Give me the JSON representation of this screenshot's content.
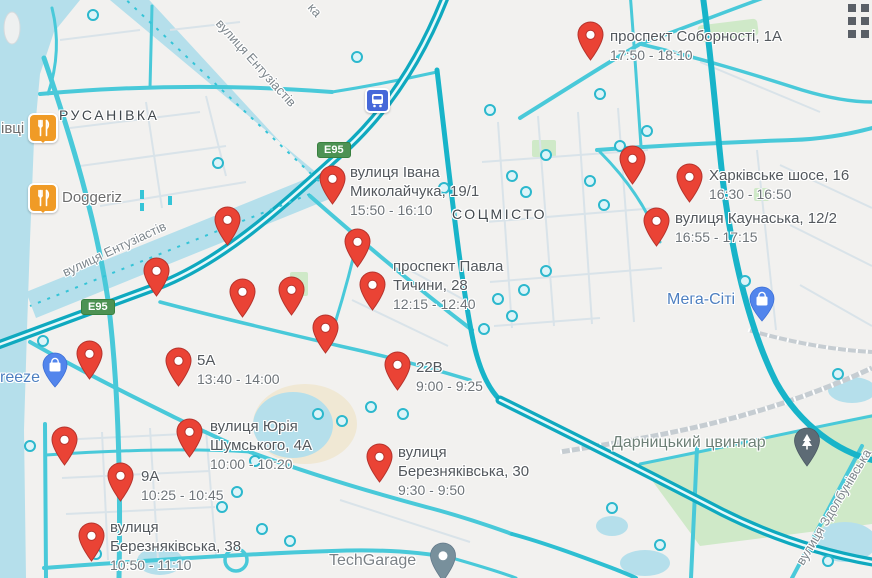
{
  "area_labels": {
    "rusanivka": "РУСАНІВКА",
    "sotsmisto": "СОЦМІСТО"
  },
  "street_labels": {
    "entuziastiv_top": "вулиця Ентузіастів",
    "entuziastiv_left": "вулиця Ентузіастів",
    "zdolbunivska": "вулиця Здолбунівська",
    "partial_top": "ка"
  },
  "route_badges": {
    "e95_top": "E95",
    "e95_left": "E95"
  },
  "pois": {
    "restaurant_partial": "івці",
    "doggeriz": "Doggeriz",
    "freeze_partial": "reeze",
    "mega_city": "Мега-Сіті",
    "darnytsky_cemetery": "Дарницький цвинтар",
    "techgarage": "TechGarage"
  },
  "markers": [
    {
      "title": "проспект Соборності, 1А",
      "time": "17:50 - 18:10"
    },
    {
      "title": "вулиця Івана\nМиколайчука, 19/1",
      "time": "15:50 - 16:10"
    },
    {
      "title": "Харківське шосе, 16",
      "time": "16:30 - 16:50"
    },
    {
      "title": "вулиця Каунаська, 12/2",
      "time": "16:55 - 17:15"
    },
    {
      "title": "проспект Павла\nТичини, 28",
      "time": "12:15 - 12:40"
    },
    {
      "title": "5А",
      "time": "13:40 - 14:00"
    },
    {
      "title": "22В",
      "time": "9:00 - 9:25"
    },
    {
      "title": "вулиця Юрія\nШумського, 4А",
      "time": "10:00 - 10:20"
    },
    {
      "title": "вулиця\nБерезняківська, 30",
      "time": "9:30 - 9:50"
    },
    {
      "title": "9А",
      "time": "10:25 - 10:45"
    },
    {
      "title": "вулиця\nБерезняківська, 38",
      "time": "10:50 - 11:10"
    }
  ],
  "colors": {
    "marker_red": "#EA4335",
    "road_teal": "#18b4c9",
    "water": "#b5dfeb",
    "green": "#cfe9c8",
    "badge_green": "#4d9253",
    "poi_blue": "#4d7fc0",
    "poi_orange": "#f09b26"
  }
}
